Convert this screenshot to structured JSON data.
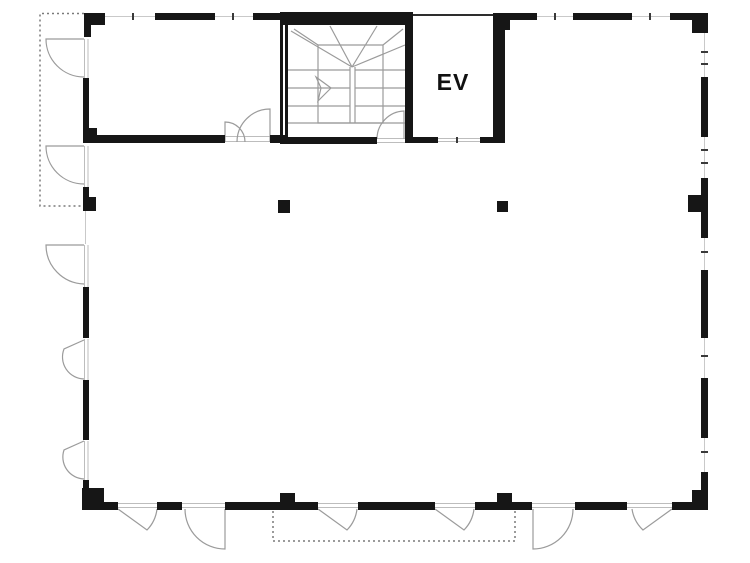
{
  "page": {
    "background": "#ffffff"
  },
  "floor_plan": {
    "elevator_label": "EV",
    "colors": {
      "wall": "#161616",
      "thin_line": "#9b9b9b",
      "jamb_line": "#bdbdbd",
      "glazing_line": "#c9c9c9",
      "tick": "#3a3a3a",
      "medium_line": "#2e2e2e",
      "dotted": "#7a7a7a",
      "background": "#ffffff"
    },
    "icons": {
      "stairs": "stairs-symbol",
      "elevator": "elevator-shaft-symbol",
      "doors": "door-swing-symbol",
      "columns": "structural-column-symbol",
      "setback": "dashed-outline-symbol"
    }
  }
}
